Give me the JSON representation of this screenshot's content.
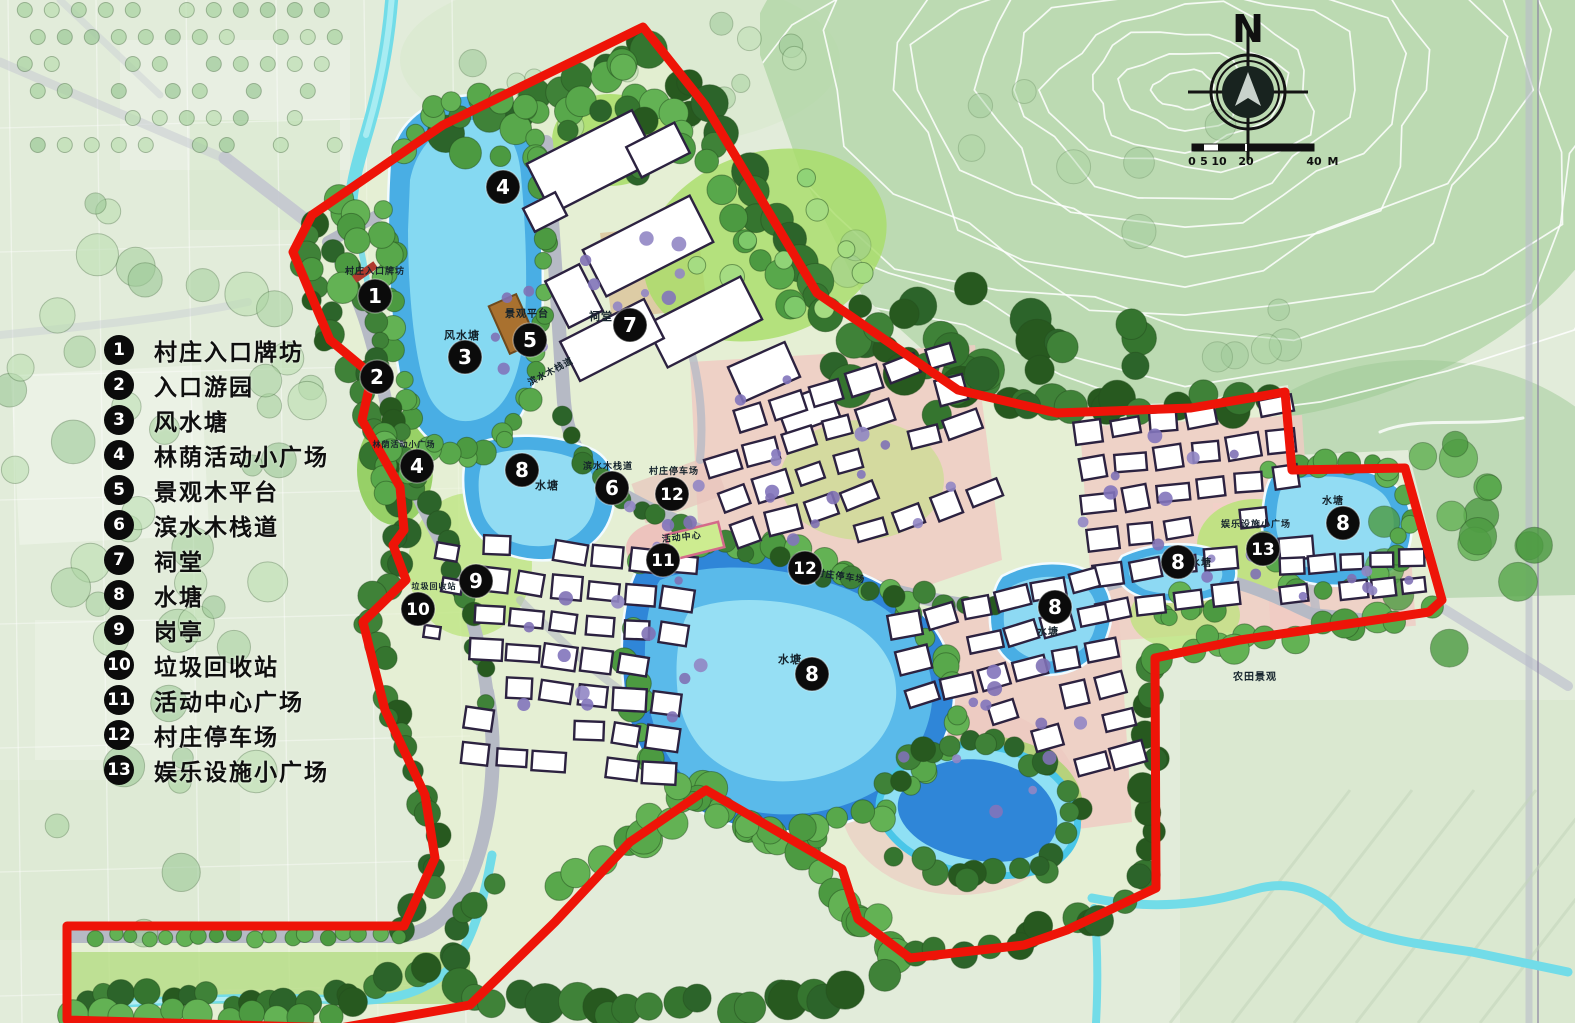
{
  "map": {
    "compass": {
      "label": "N"
    },
    "scale_bar": {
      "ticks": [
        {
          "t": "0",
          "x": 0
        },
        {
          "t": "5",
          "x": 12
        },
        {
          "t": "10",
          "x": 27
        },
        {
          "t": "20",
          "x": 54
        },
        {
          "t": "40",
          "x": 122
        },
        {
          "t": "M",
          "x": 141
        }
      ]
    },
    "legend": {
      "items": [
        {
          "num": "1",
          "label": "村庄入口牌坊"
        },
        {
          "num": "2",
          "label": "入口游园"
        },
        {
          "num": "3",
          "label": "风水塘"
        },
        {
          "num": "4",
          "label": "林荫活动小广场"
        },
        {
          "num": "5",
          "label": "景观木平台"
        },
        {
          "num": "6",
          "label": "滨水木栈道"
        },
        {
          "num": "7",
          "label": "祠堂"
        },
        {
          "num": "8",
          "label": "水塘"
        },
        {
          "num": "9",
          "label": "岗亭"
        },
        {
          "num": "10",
          "label": "垃圾回收站"
        },
        {
          "num": "11",
          "label": "活动中心广场"
        },
        {
          "num": "12",
          "label": "村庄停车场"
        },
        {
          "num": "13",
          "label": "娱乐设施小广场"
        }
      ]
    },
    "markers": [
      {
        "n": "1",
        "x": 375,
        "y": 296
      },
      {
        "n": "2",
        "x": 377,
        "y": 377
      },
      {
        "n": "3",
        "x": 465,
        "y": 357
      },
      {
        "n": "4",
        "x": 503,
        "y": 187
      },
      {
        "n": "4",
        "x": 417,
        "y": 466
      },
      {
        "n": "5",
        "x": 530,
        "y": 340
      },
      {
        "n": "6",
        "x": 612,
        "y": 488
      },
      {
        "n": "7",
        "x": 630,
        "y": 325
      },
      {
        "n": "8",
        "x": 522,
        "y": 470
      },
      {
        "n": "8",
        "x": 812,
        "y": 674
      },
      {
        "n": "8",
        "x": 1055,
        "y": 607
      },
      {
        "n": "8",
        "x": 1178,
        "y": 562
      },
      {
        "n": "8",
        "x": 1343,
        "y": 523
      },
      {
        "n": "9",
        "x": 476,
        "y": 581
      },
      {
        "n": "10",
        "x": 418,
        "y": 609
      },
      {
        "n": "11",
        "x": 663,
        "y": 560
      },
      {
        "n": "12",
        "x": 672,
        "y": 494
      },
      {
        "n": "12",
        "x": 805,
        "y": 568
      },
      {
        "n": "13",
        "x": 1263,
        "y": 549
      }
    ],
    "labels": [
      {
        "text": "村庄入口牌坊",
        "x": 375,
        "y": 274,
        "size": 9,
        "rot": 0
      },
      {
        "text": "风水塘",
        "x": 462,
        "y": 339,
        "size": 11,
        "rot": 0
      },
      {
        "text": "景观平台",
        "x": 527,
        "y": 317,
        "size": 10,
        "rot": 0
      },
      {
        "text": "祠堂",
        "x": 601,
        "y": 320,
        "size": 11,
        "rot": 0
      },
      {
        "text": "滨水木栈道",
        "x": 552,
        "y": 374,
        "size": 9,
        "rot": -28
      },
      {
        "text": "水塘",
        "x": 547,
        "y": 489,
        "size": 11,
        "rot": 0
      },
      {
        "text": "滨水木栈道",
        "x": 608,
        "y": 469,
        "size": 9,
        "rot": 0
      },
      {
        "text": "村庄停车场",
        "x": 674,
        "y": 474,
        "size": 9,
        "rot": 0
      },
      {
        "text": "活动中心",
        "x": 682,
        "y": 540,
        "size": 9,
        "rot": -6
      },
      {
        "text": "林荫活动小广场",
        "x": 404,
        "y": 447,
        "size": 8,
        "rot": 0
      },
      {
        "text": "垃圾回收站",
        "x": 434,
        "y": 589,
        "size": 8,
        "rot": 0
      },
      {
        "text": "村庄停车场",
        "x": 840,
        "y": 579,
        "size": 9,
        "rot": 8
      },
      {
        "text": "水塘",
        "x": 790,
        "y": 663,
        "size": 11,
        "rot": 0
      },
      {
        "text": "水塘",
        "x": 1048,
        "y": 635,
        "size": 10,
        "rot": 0
      },
      {
        "text": "水塘",
        "x": 1201,
        "y": 566,
        "size": 10,
        "rot": 0
      },
      {
        "text": "水塘",
        "x": 1333,
        "y": 504,
        "size": 10,
        "rot": 0
      },
      {
        "text": "娱乐设施小广场",
        "x": 1256,
        "y": 527,
        "size": 9,
        "rot": 0
      },
      {
        "text": "农田景观",
        "x": 1255,
        "y": 680,
        "size": 10,
        "rot": 0
      }
    ],
    "colors": {
      "boundary_red": "#ee1408",
      "water_light": "#8fe0f4",
      "water_mid": "#49aee4",
      "water_deep": "#2f86d8",
      "tree_dark": "#2c642a",
      "tree_mid": "#4c9a41",
      "tree_light": "#7ec96a",
      "lawn": "#a8dd66",
      "road_gray": "#b6bac5",
      "plaza_pink": "#f0cbc3",
      "courtyard_tan": "#dcc8a0",
      "building_outline": "#2c2240",
      "shrub_purple": "#8274bb",
      "marker_black": "#0b0b0b",
      "deck_brown": "#a9712f"
    }
  }
}
